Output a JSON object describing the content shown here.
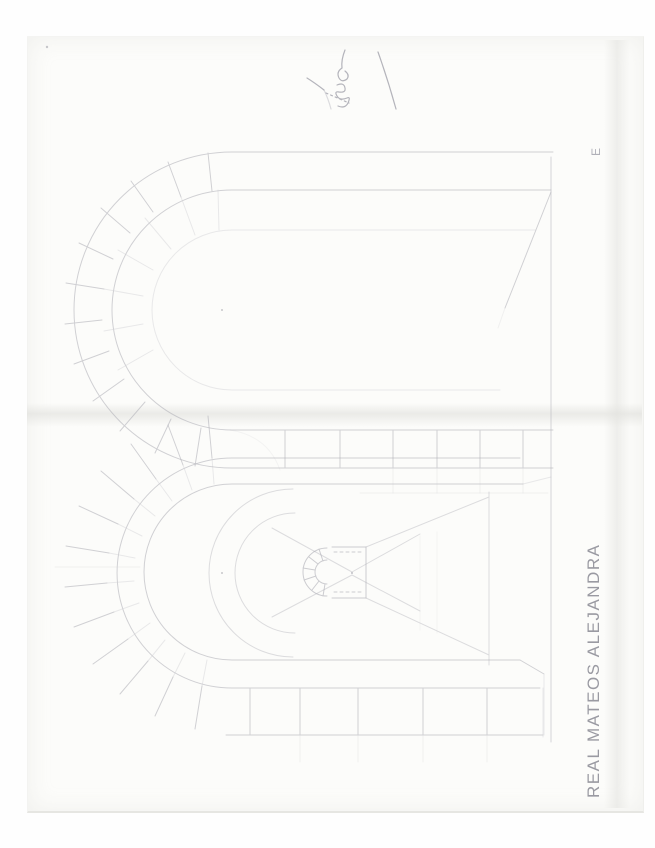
{
  "signature": {
    "name": "REAL MATEOS ALEJANDRA",
    "corner_letter": "E"
  },
  "colors": {
    "background": "#fefefe",
    "paper": "#fcfcfa",
    "pencil": "#adadb5",
    "pencil_dark": "#9c9ca6",
    "ink": "#9a9aa2"
  }
}
